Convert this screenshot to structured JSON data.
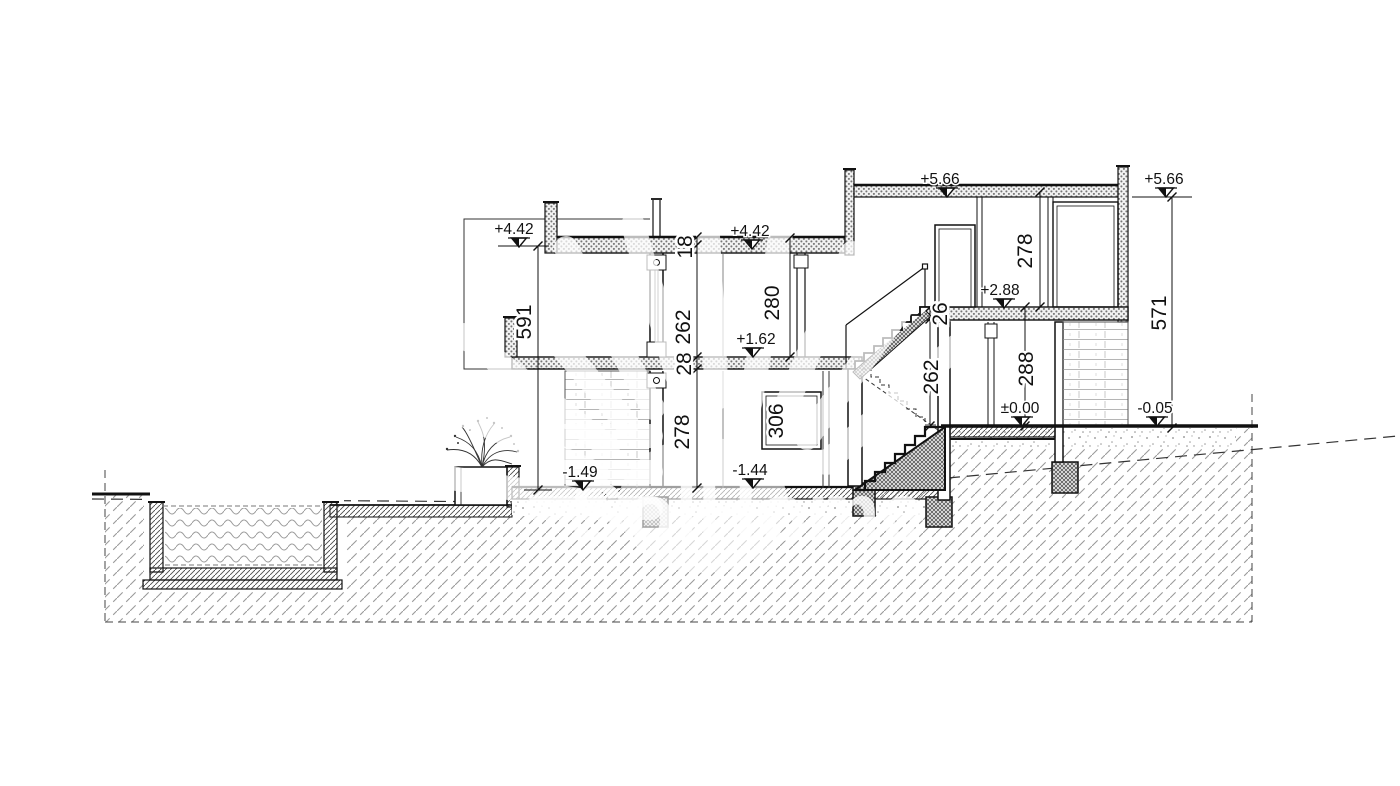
{
  "drawing": {
    "description": "architectural cross-section of a split-level house on a slope with pool",
    "watermark": {
      "text": "SolHome"
    },
    "colors": {
      "line": "#111111",
      "hatch": "#999999",
      "brick": "#b5b5b5",
      "speckle": "#8c8c8c",
      "background": "#ffffff"
    },
    "levels": {
      "p566_mid": "+5.66",
      "p566_right": "+5.66",
      "p442_left": "+4.42",
      "p442_mid": "+4.42",
      "p288": "+2.88",
      "p162": "+1.62",
      "zero": "±0.00",
      "m005": "-0.05",
      "m144": "-1.44",
      "m149": "-1.49"
    },
    "dimensions": {
      "d591": "591",
      "d571": "571",
      "d18": "18",
      "d262_mid": "262",
      "d28": "28",
      "d278_mid": "278",
      "d280": "280",
      "d26": "26",
      "d262_stair": "262",
      "d288": "288",
      "d278_right": "278",
      "d306": "306"
    }
  }
}
